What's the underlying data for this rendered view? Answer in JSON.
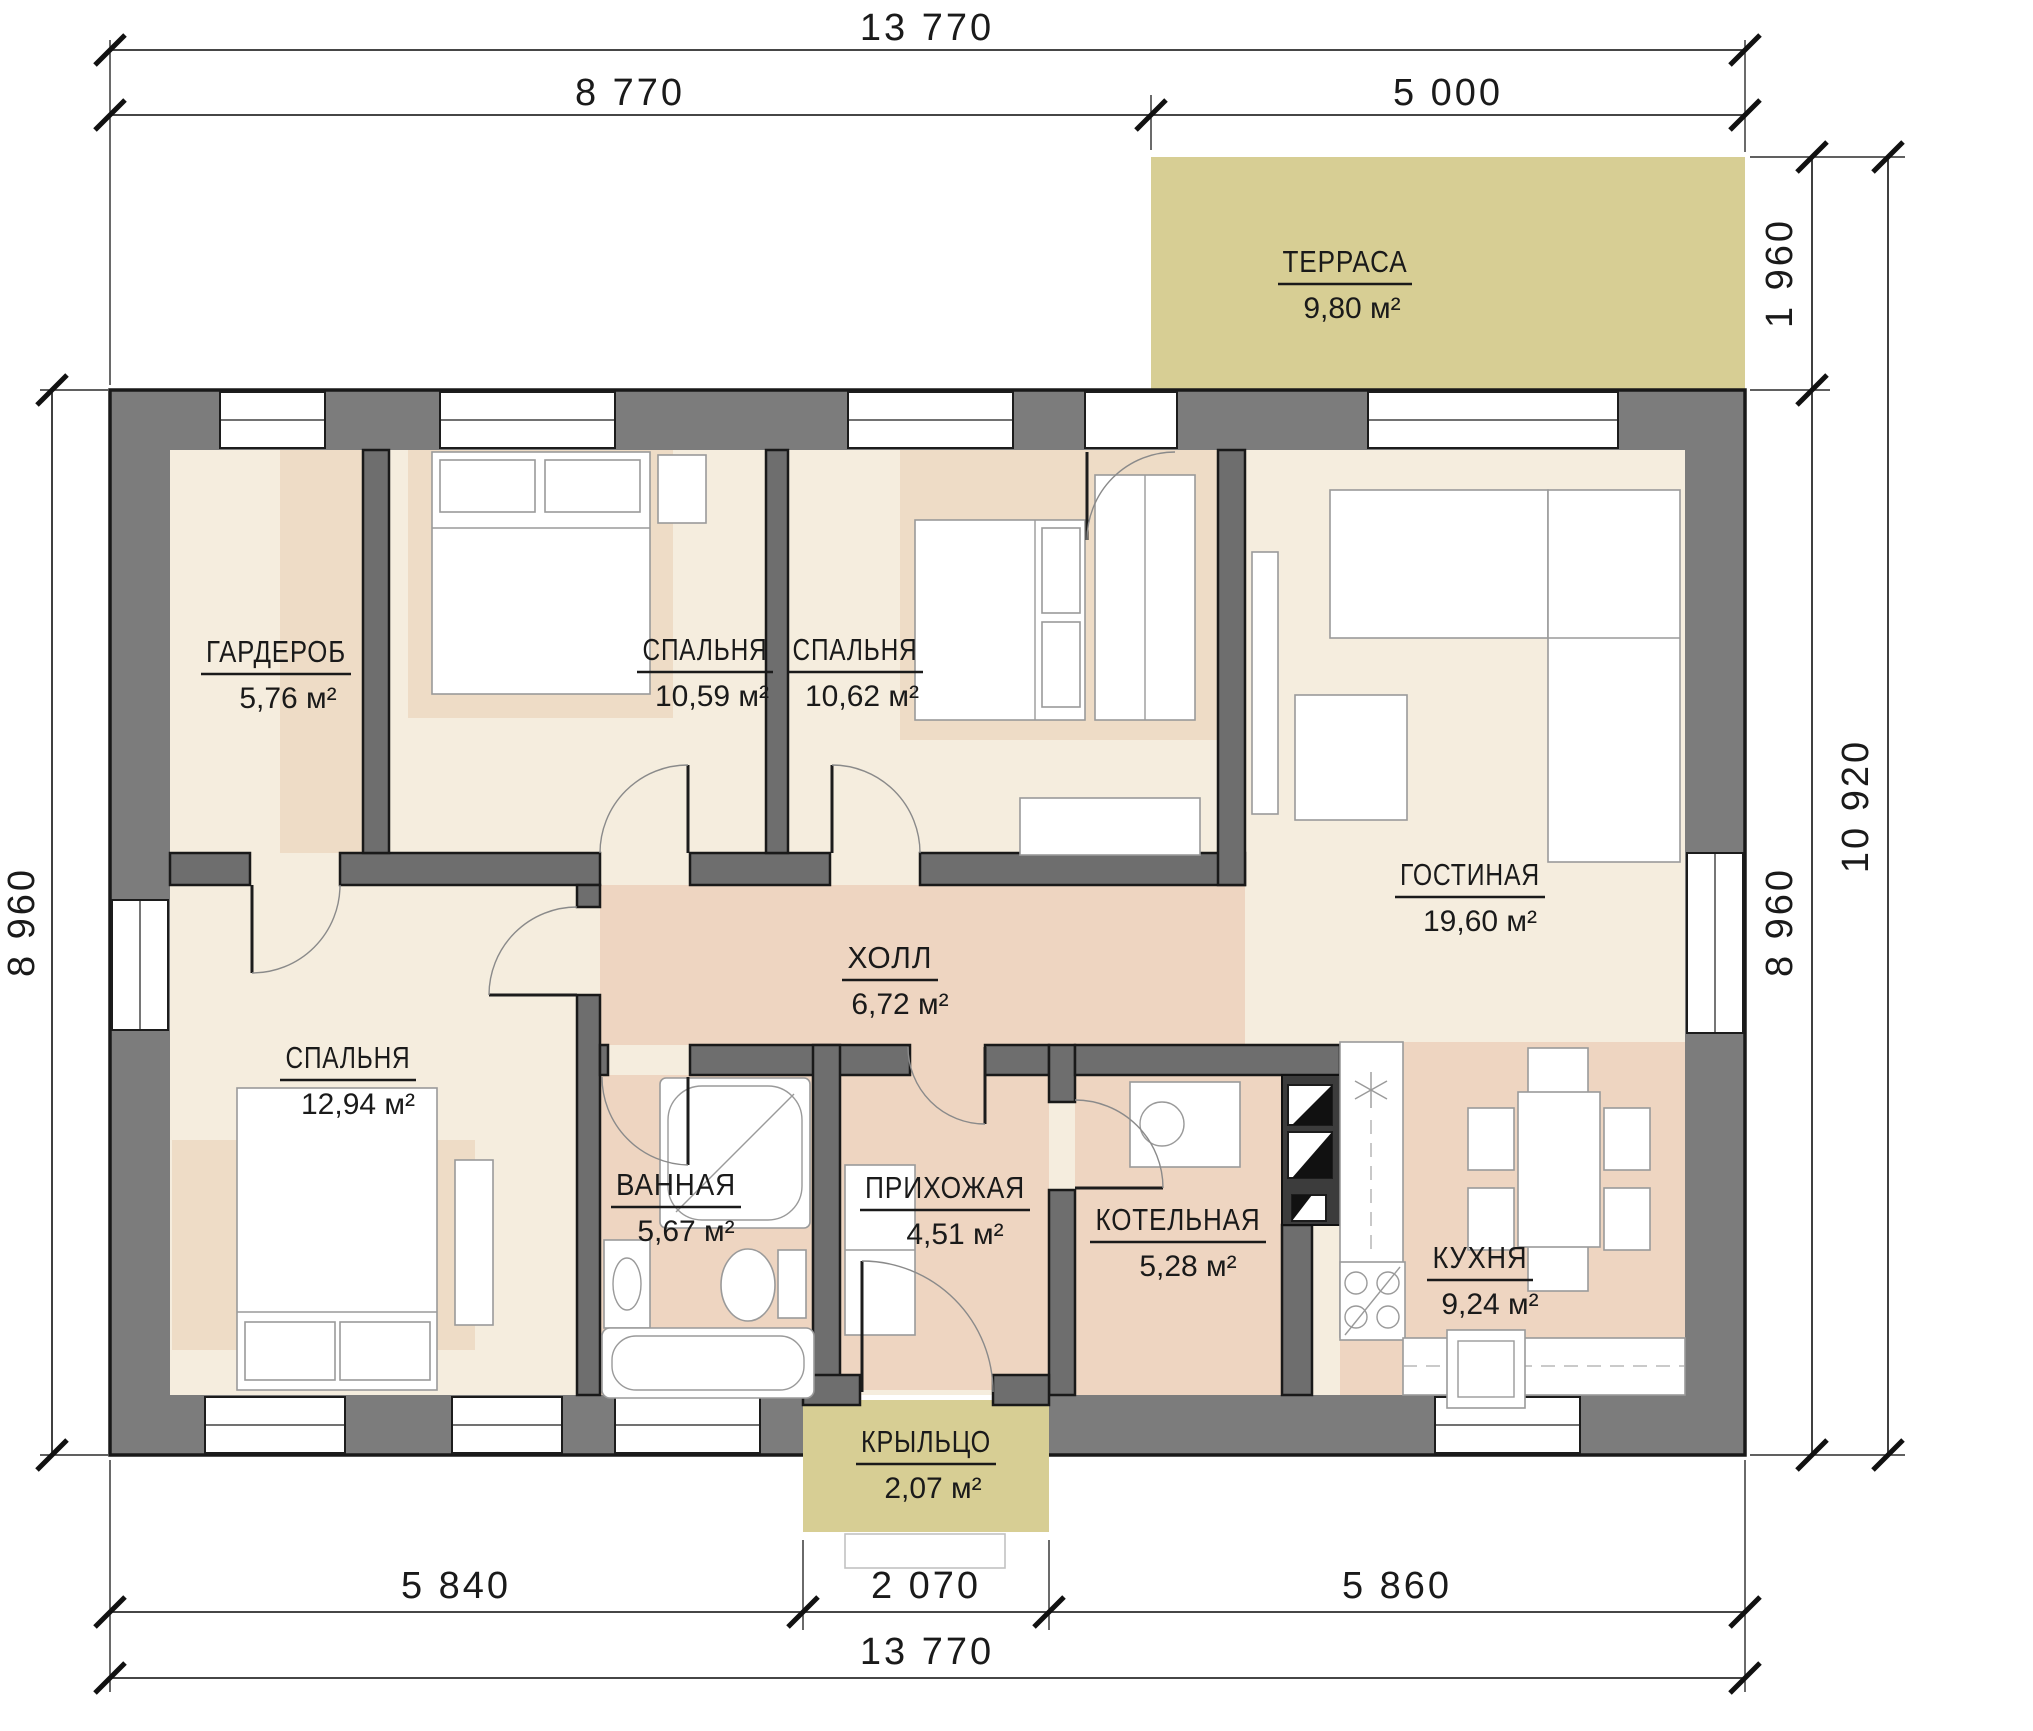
{
  "plan": {
    "type": "floor-plan",
    "language": "ru",
    "rooms": {
      "terrace": {
        "name": "ТЕРРАСА",
        "area": "9,80 м²"
      },
      "garderob": {
        "name": "ГАРДЕРОБ",
        "area": "5,76 м²"
      },
      "bedroom1": {
        "name": "СПАЛЬНЯ",
        "area": "10,59 м²"
      },
      "bedroom2": {
        "name": "СПАЛЬНЯ",
        "area": "10,62 м²"
      },
      "living": {
        "name": "ГОСТИНАЯ",
        "area": "19,60 м²"
      },
      "hall": {
        "name": "ХОЛЛ",
        "area": "6,72 м²"
      },
      "bedroom3": {
        "name": "СПАЛЬНЯ",
        "area": "12,94 м²"
      },
      "bathroom": {
        "name": "ВАННАЯ",
        "area": "5,67 м²"
      },
      "entry": {
        "name": "ПРИХОЖАЯ",
        "area": "4,51 м²"
      },
      "boiler": {
        "name": "КОТЕЛЬНАЯ",
        "area": "5,28 м²"
      },
      "kitchen": {
        "name": "КУХНЯ",
        "area": "9,24 м²"
      },
      "porch": {
        "name": "КРЫЛЬЦО",
        "area": "2,07 м²"
      }
    },
    "dimensions": {
      "top_total": "13 770",
      "top_left": "8 770",
      "top_right": "5 000",
      "right_terrace": "1 960",
      "right_house": "8 960",
      "right_total": "10 920",
      "left_house": "8 960",
      "bottom_left": "5 840",
      "bottom_porch": "2 070",
      "bottom_right": "5 860",
      "bottom_total": "13 770"
    },
    "colors": {
      "exterior_wall": "#7c7c7c",
      "interior_wall": "#6e6e6e",
      "floor_cream": "#f5edde",
      "floor_pink": "#eed5c1",
      "floor_accent_tan": "#eedcc6",
      "outdoor_khaki": "#d7ce94",
      "line": "#1a1a1a"
    }
  }
}
